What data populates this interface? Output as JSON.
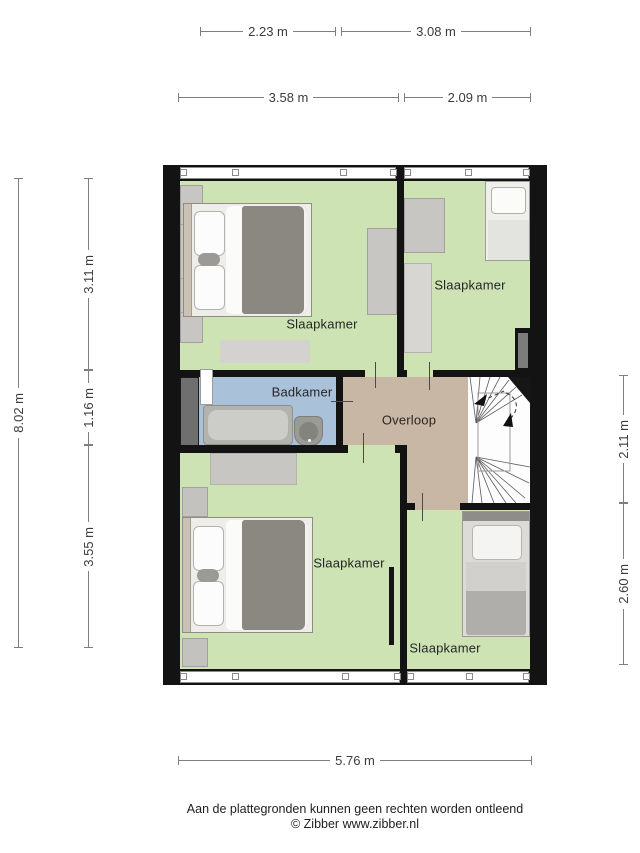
{
  "dimensions": {
    "t1a": "2.23 m",
    "t1b": "3.08 m",
    "t2a": "3.58 m",
    "t2b": "2.09 m",
    "left_total": "8.02 m",
    "l1": "3.11 m",
    "l2": "1.16 m",
    "l3": "3.55 m",
    "r1": "2.11 m",
    "r2": "2.60 m",
    "bottom": "5.76 m"
  },
  "rooms": {
    "bedroom_tl": "Slaapkamer",
    "bedroom_tr": "Slaapkamer",
    "bathroom": "Badkamer",
    "landing": "Overloop",
    "bedroom_bl": "Slaapkamer",
    "bedroom_br": "Slaapkamer"
  },
  "footer": {
    "disclaimer": "Aan de plattegronden kunnen geen rechten worden ontleend",
    "copyright": "© Zibber www.zibber.nl"
  },
  "colors": {
    "room_green": "#cee3b4",
    "bathroom_blue": "#a9c2da",
    "landing_tan": "#c9b7a6",
    "wall": "#131313",
    "dim_line": "#7f7f7f",
    "label_text": "#262626"
  }
}
